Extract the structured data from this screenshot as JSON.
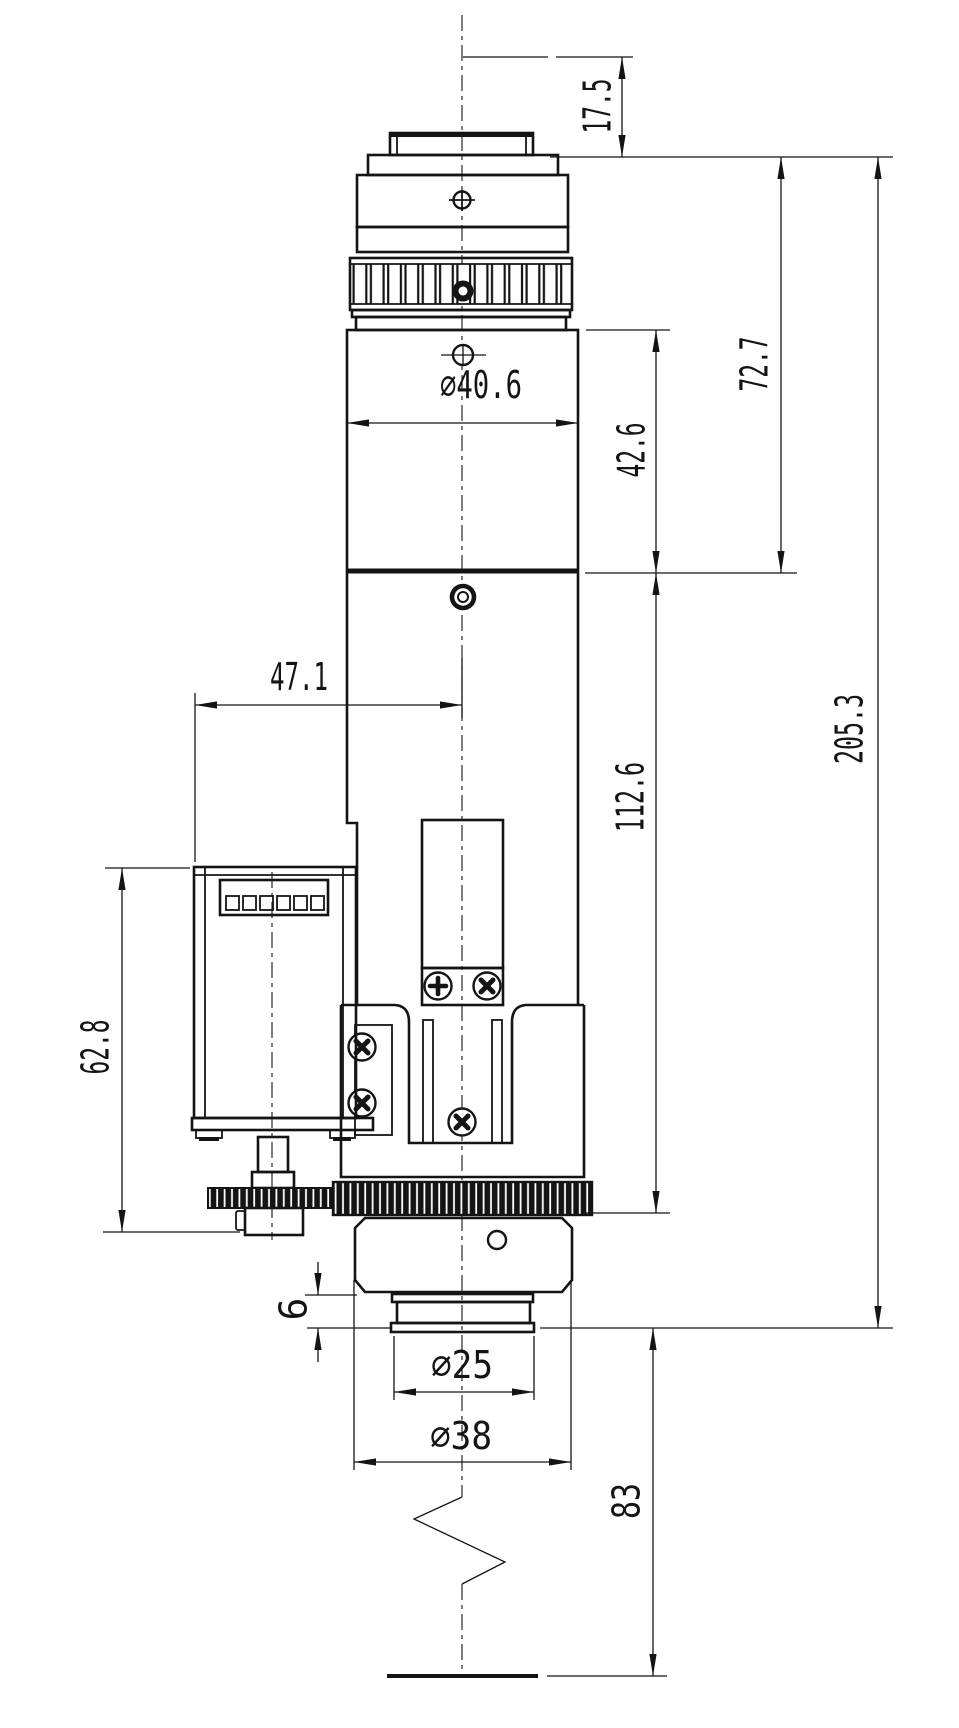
{
  "drawing": {
    "title": "motorized-lens-assembly-dimension-drawing",
    "units": "mm",
    "line_color": "#141414",
    "bg_color": "#ffffff",
    "dims": {
      "top_flange_offset": {
        "label": "17.5"
      },
      "upper_section_height": {
        "label": "72.7"
      },
      "tube_height": {
        "label": "42.6"
      },
      "tube_diameter": {
        "label": "∅40.6"
      },
      "motor_face_offset": {
        "label": "47.1"
      },
      "lower_section_height": {
        "label": "112.6"
      },
      "motor_unit_height": {
        "label": "62.8"
      },
      "overall_height": {
        "label": "205.3"
      },
      "tip_step_height": {
        "label": "6"
      },
      "tip_diameter": {
        "label": "∅25"
      },
      "housing_diameter": {
        "label": "∅38"
      },
      "working_distance": {
        "label": "83"
      }
    }
  }
}
